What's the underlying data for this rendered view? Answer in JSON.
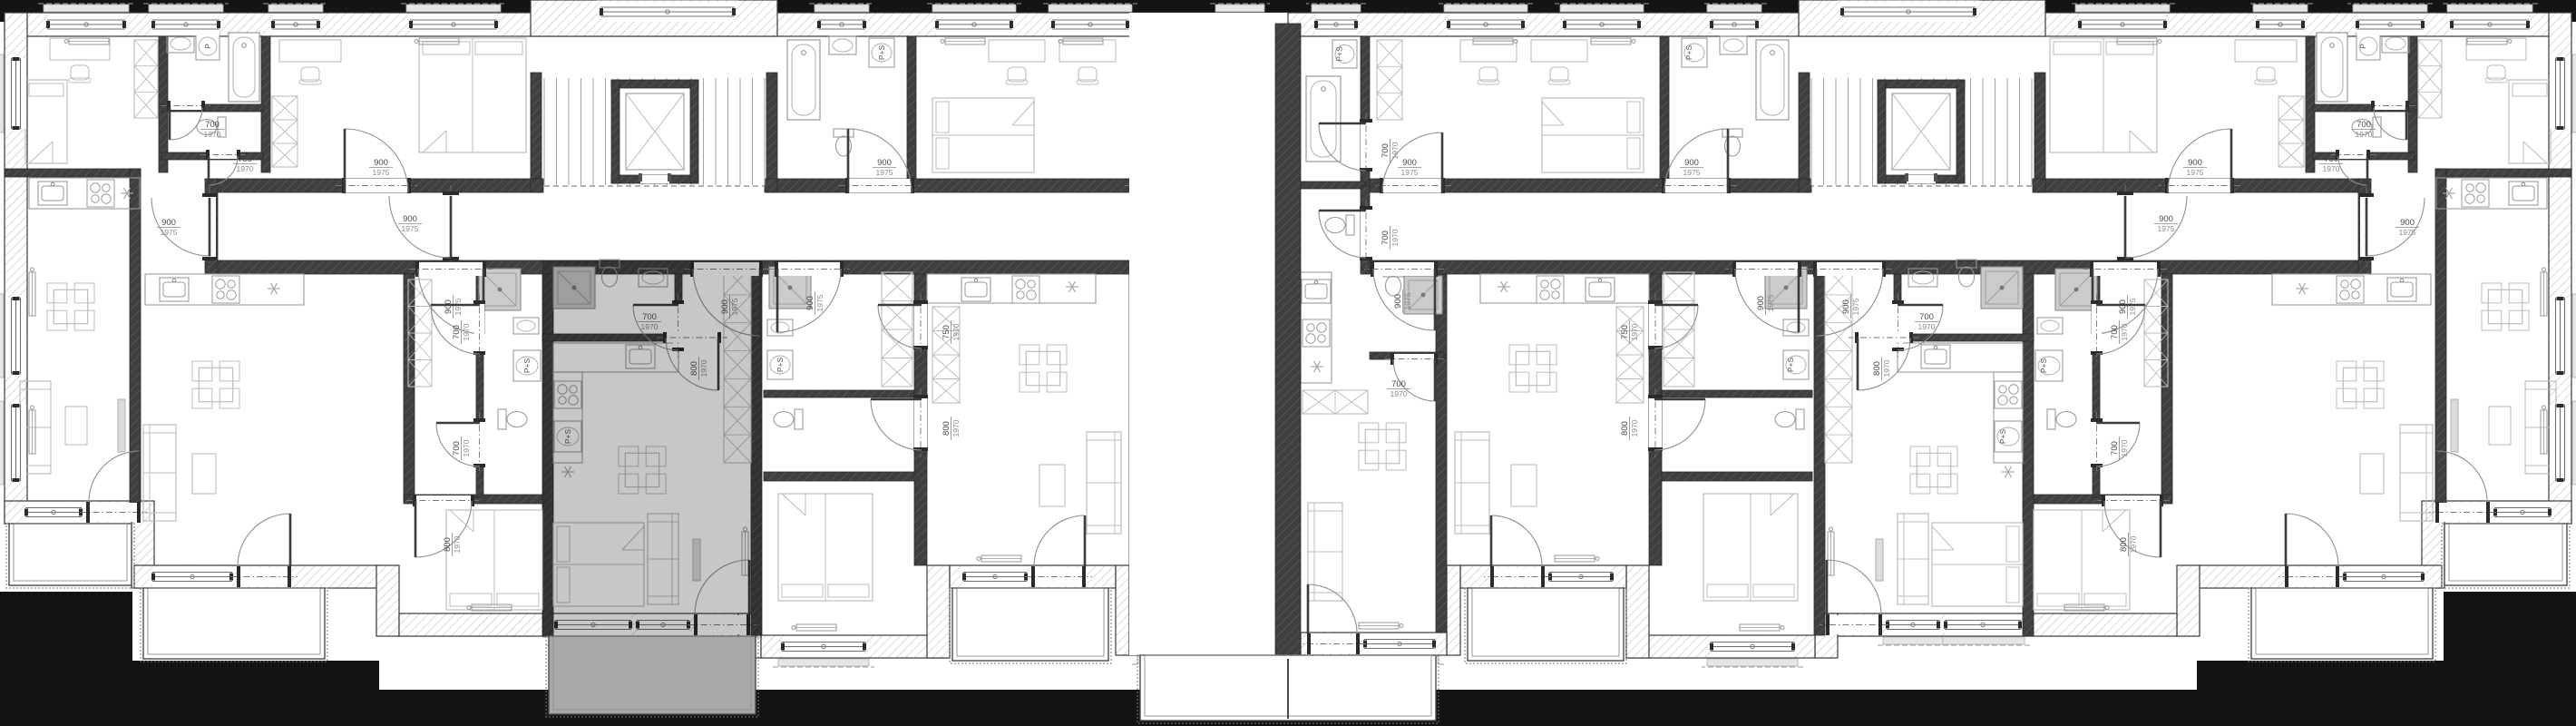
{
  "plan": {
    "door_labels": {
      "700": {
        "width": "700",
        "height": "1970"
      },
      "750": {
        "width": "750",
        "height": "1970"
      },
      "800": {
        "width": "800",
        "height": "1970"
      },
      "900": {
        "width": "900",
        "height": "1975"
      }
    },
    "fixture_labels": {
      "washer_dryer": "P+S",
      "washer": "P"
    },
    "colors": {
      "outside_black": "#141414",
      "paper": "#ffffff",
      "wall_dark": "#3f3f3f",
      "wall_hatch_line": "#5c5c5c",
      "exterior_hatch_line": "#c3c3c3",
      "wall_edge": "#2b2b2b",
      "furniture_line": "#bdbdbd",
      "fixture_fill": "#cbcbcb",
      "door_arc": "#8f8f8f",
      "door_leaf": "#3c3c3c",
      "dimension_text": "#4a4a4a",
      "dimension_sub": "#8a8a8a",
      "window_line": "#6f6f6f",
      "sill_fill": "#e6e6e6",
      "stair_tread": "#a5a5a5",
      "highlight_fill": "#8f8f8f",
      "highlight_balcony": "#a8a8a8"
    }
  }
}
